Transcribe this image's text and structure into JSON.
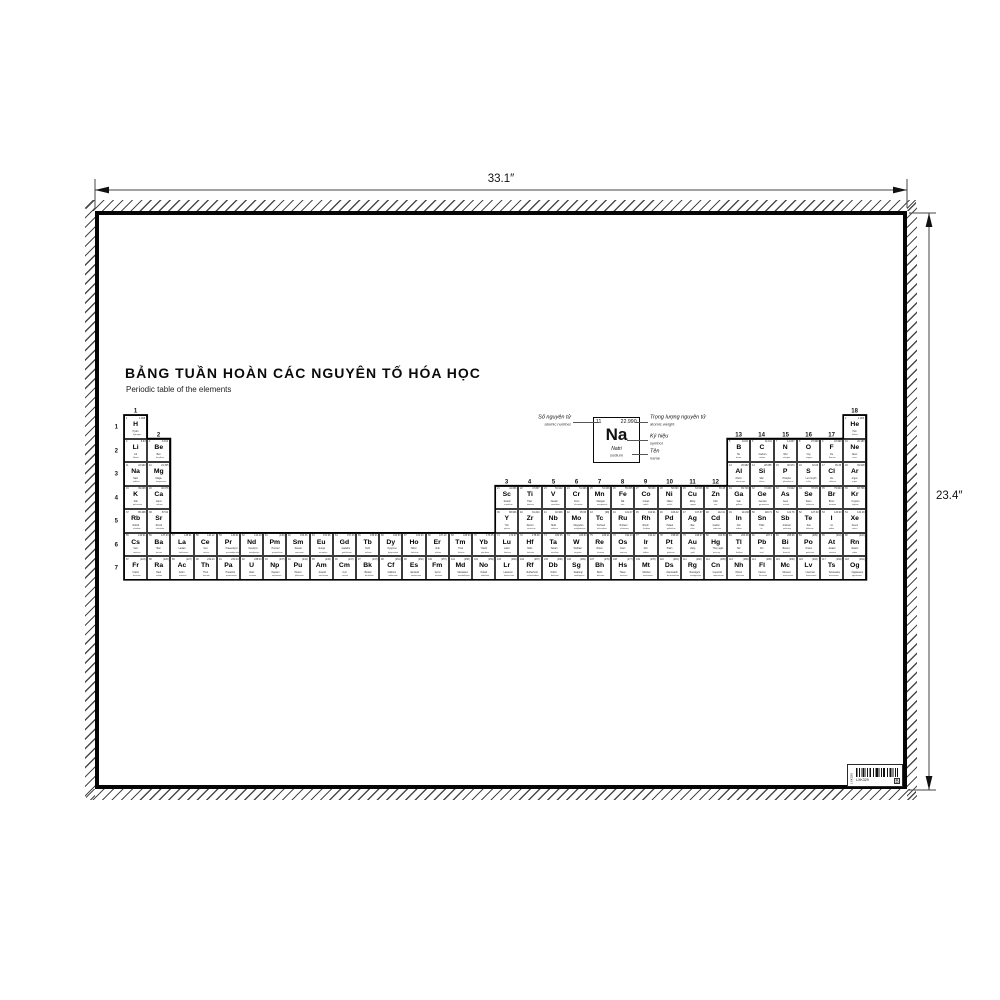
{
  "poster": {
    "title": "BẢNG TUẦN HOÀN CÁC NGUYÊN TỐ HÓA HỌC",
    "subtitle": "Periodic table of the elements"
  },
  "dimensions": {
    "width": "33.1″",
    "height": "23.4″"
  },
  "legend": {
    "atomic_number_vi": "Số nguyên tử",
    "atomic_number_en": "atomic number",
    "atomic_weight_vi": "Trọng lượng nguyên tử",
    "atomic_weight_en": "atomic weight",
    "symbol_vi": "Ký hiệu",
    "symbol_en": "symbol",
    "name_vi": "Tên",
    "name_en": "name",
    "example": {
      "number": "11",
      "weight": "22.990",
      "symbol": "Na",
      "name_vi": "Natri",
      "name_en": "sodium"
    }
  },
  "table": {
    "period_labels": [
      "1",
      "2",
      "3",
      "4",
      "5",
      "6",
      "7"
    ],
    "group_labels": [
      [
        "1",
        1,
        1
      ],
      [
        "2",
        2,
        2
      ],
      [
        "3",
        17,
        4
      ],
      [
        "4",
        18,
        4
      ],
      [
        "5",
        19,
        4
      ],
      [
        "6",
        20,
        4
      ],
      [
        "7",
        21,
        4
      ],
      [
        "8",
        22,
        4
      ],
      [
        "9",
        23,
        4
      ],
      [
        "10",
        24,
        4
      ],
      [
        "11",
        25,
        4
      ],
      [
        "12",
        26,
        4
      ],
      [
        "13",
        27,
        2
      ],
      [
        "14",
        28,
        2
      ],
      [
        "15",
        29,
        2
      ],
      [
        "16",
        30,
        2
      ],
      [
        "17",
        31,
        2
      ],
      [
        "18",
        32,
        1
      ]
    ],
    "elements": [
      [
        1,
        "H",
        "1.008",
        "Hydro",
        "hydrogen"
      ],
      [
        2,
        "He",
        "4.003",
        "Heli",
        "helium"
      ],
      [
        3,
        "Li",
        "6.94",
        "Liti",
        "lithium"
      ],
      [
        4,
        "Be",
        "9.012",
        "Beri",
        "beryllium"
      ],
      [
        5,
        "B",
        "10.81",
        "Bo",
        "boron"
      ],
      [
        6,
        "C",
        "12.011",
        "Cacbon",
        "carbon"
      ],
      [
        7,
        "N",
        "14.007",
        "Nitơ",
        "nitrogen"
      ],
      [
        8,
        "O",
        "15.999",
        "Oxy",
        "oxygen"
      ],
      [
        9,
        "F",
        "18.998",
        "Flo",
        "fluorine"
      ],
      [
        10,
        "Ne",
        "20.180",
        "Neon",
        "neon"
      ],
      [
        11,
        "Na",
        "22.990",
        "Natri",
        "sodium"
      ],
      [
        12,
        "Mg",
        "24.305",
        "Magie",
        "magnesium"
      ],
      [
        13,
        "Al",
        "26.982",
        "Nhôm",
        "aluminium"
      ],
      [
        14,
        "Si",
        "28.085",
        "Silic",
        "silicon"
      ],
      [
        15,
        "P",
        "30.974",
        "Photpho",
        "phosphorus"
      ],
      [
        16,
        "S",
        "32.06",
        "Lưu huỳnh",
        "sulfur"
      ],
      [
        17,
        "Cl",
        "35.45",
        "Clo",
        "chlorine"
      ],
      [
        18,
        "Ar",
        "39.948",
        "Argon",
        "argon"
      ],
      [
        19,
        "K",
        "39.098",
        "Kali",
        "potassium"
      ],
      [
        20,
        "Ca",
        "40.078",
        "Canxi",
        "calcium"
      ],
      [
        21,
        "Sc",
        "44.956",
        "Scandi",
        "scandium"
      ],
      [
        22,
        "Ti",
        "47.867",
        "Titan",
        "titanium"
      ],
      [
        23,
        "V",
        "50.942",
        "Vanadi",
        "vanadium"
      ],
      [
        24,
        "Cr",
        "51.996",
        "Crom",
        "chromium"
      ],
      [
        25,
        "Mn",
        "54.938",
        "Mangan",
        "manganese"
      ],
      [
        26,
        "Fe",
        "55.845",
        "Sắt",
        "iron"
      ],
      [
        27,
        "Co",
        "58.933",
        "Coban",
        "cobalt"
      ],
      [
        28,
        "Ni",
        "58.693",
        "Niken",
        "nickel"
      ],
      [
        29,
        "Cu",
        "63.546",
        "Đồng",
        "copper"
      ],
      [
        30,
        "Zn",
        "65.38",
        "Kẽm",
        "zinc"
      ],
      [
        31,
        "Ga",
        "69.723",
        "Gali",
        "gallium"
      ],
      [
        32,
        "Ge",
        "72.630",
        "Gemani",
        "germanium"
      ],
      [
        33,
        "As",
        "74.922",
        "Asen",
        "arsenic"
      ],
      [
        34,
        "Se",
        "78.971",
        "Selen",
        "selenium"
      ],
      [
        35,
        "Br",
        "79.904",
        "Brom",
        "bromine"
      ],
      [
        36,
        "Kr",
        "83.798",
        "Krypton",
        "krypton"
      ],
      [
        37,
        "Rb",
        "85.468",
        "Rubidi",
        "rubidium"
      ],
      [
        38,
        "Sr",
        "87.62",
        "Stronti",
        "strontium"
      ],
      [
        39,
        "Y",
        "88.906",
        "Yttri",
        "yttrium"
      ],
      [
        40,
        "Zr",
        "91.224",
        "Zirconi",
        "zirconium"
      ],
      [
        41,
        "Nb",
        "92.906",
        "Niobi",
        "niobium"
      ],
      [
        42,
        "Mo",
        "95.95",
        "Molypden",
        "molybdenum"
      ],
      [
        43,
        "Tc",
        "(98)",
        "Techneti",
        "technetium"
      ],
      [
        44,
        "Ru",
        "101.07",
        "Rutheni",
        "ruthenium"
      ],
      [
        45,
        "Rh",
        "102.91",
        "Rhodi",
        "rhodium"
      ],
      [
        46,
        "Pd",
        "106.42",
        "Paladi",
        "palladium"
      ],
      [
        47,
        "Ag",
        "107.87",
        "Bạc",
        "silver"
      ],
      [
        48,
        "Cd",
        "112.41",
        "Cadimi",
        "cadmium"
      ],
      [
        49,
        "In",
        "114.82",
        "Indi",
        "indium"
      ],
      [
        50,
        "Sn",
        "118.71",
        "Thiếc",
        "tin"
      ],
      [
        51,
        "Sb",
        "121.76",
        "Antimon",
        "antimony"
      ],
      [
        52,
        "Te",
        "127.60",
        "Telu",
        "tellurium"
      ],
      [
        53,
        "I",
        "126.90",
        "Iot",
        "iodine"
      ],
      [
        54,
        "Xe",
        "131.29",
        "Xenon",
        "xenon"
      ],
      [
        55,
        "Cs",
        "132.91",
        "Xesi",
        "caesium"
      ],
      [
        56,
        "Ba",
        "137.33",
        "Bari",
        "barium"
      ],
      [
        57,
        "La",
        "138.91",
        "Lantan",
        "lanthanum"
      ],
      [
        58,
        "Ce",
        "140.12",
        "Ceri",
        "cerium"
      ],
      [
        59,
        "Pr",
        "140.91",
        "Praseodymi",
        "praseodymium"
      ],
      [
        60,
        "Nd",
        "144.24",
        "Neodymi",
        "neodymium"
      ],
      [
        61,
        "Pm",
        "(145)",
        "Prometi",
        "promethium"
      ],
      [
        62,
        "Sm",
        "150.36",
        "Samari",
        "samarium"
      ],
      [
        63,
        "Eu",
        "151.96",
        "Europi",
        "europium"
      ],
      [
        64,
        "Gd",
        "157.25",
        "Gadolini",
        "gadolinium"
      ],
      [
        65,
        "Tb",
        "158.93",
        "Terbi",
        "terbium"
      ],
      [
        66,
        "Dy",
        "162.50",
        "Dysprosi",
        "dysprosium"
      ],
      [
        67,
        "Ho",
        "164.93",
        "Holmi",
        "holmium"
      ],
      [
        68,
        "Er",
        "167.26",
        "Erbi",
        "erbium"
      ],
      [
        69,
        "Tm",
        "168.93",
        "Thuli",
        "thulium"
      ],
      [
        70,
        "Yb",
        "173.05",
        "Ytterbi",
        "ytterbium"
      ],
      [
        71,
        "Lu",
        "174.97",
        "Luteti",
        "lutetium"
      ],
      [
        72,
        "Hf",
        "178.49",
        "Hafni",
        "hafnium"
      ],
      [
        73,
        "Ta",
        "180.95",
        "Tantan",
        "tantalum"
      ],
      [
        74,
        "W",
        "183.84",
        "Wolfram",
        "tungsten"
      ],
      [
        75,
        "Re",
        "186.21",
        "Rheni",
        "rhenium"
      ],
      [
        76,
        "Os",
        "190.23",
        "Osmi",
        "osmium"
      ],
      [
        77,
        "Ir",
        "192.22",
        "Iridi",
        "iridium"
      ],
      [
        78,
        "Pt",
        "195.08",
        "Platin",
        "platinum"
      ],
      [
        79,
        "Au",
        "196.97",
        "Vàng",
        "gold"
      ],
      [
        80,
        "Hg",
        "200.59",
        "Thủy ngân",
        "mercury"
      ],
      [
        81,
        "Tl",
        "204.38",
        "Tali",
        "thallium"
      ],
      [
        82,
        "Pb",
        "207.2",
        "Chì",
        "lead"
      ],
      [
        83,
        "Bi",
        "208.98",
        "Bismut",
        "bismuth"
      ],
      [
        84,
        "Po",
        "(209)",
        "Poloni",
        "polonium"
      ],
      [
        85,
        "At",
        "(210)",
        "Astatin",
        "astatine"
      ],
      [
        86,
        "Rn",
        "(222)",
        "Radon",
        "radon"
      ],
      [
        87,
        "Fr",
        "(223)",
        "Franci",
        "francium"
      ],
      [
        88,
        "Ra",
        "(226)",
        "Radi",
        "radium"
      ],
      [
        89,
        "Ac",
        "(227)",
        "Actini",
        "actinium"
      ],
      [
        90,
        "Th",
        "232.04",
        "Thori",
        "thorium"
      ],
      [
        91,
        "Pa",
        "231.04",
        "Protactini",
        "protactinium"
      ],
      [
        92,
        "U",
        "238.03",
        "Urani",
        "uranium"
      ],
      [
        93,
        "Np",
        "(237)",
        "Neptuni",
        "neptunium"
      ],
      [
        94,
        "Pu",
        "(244)",
        "Plutoni",
        "plutonium"
      ],
      [
        95,
        "Am",
        "(243)",
        "Americi",
        "americium"
      ],
      [
        96,
        "Cm",
        "(247)",
        "Curi",
        "curium"
      ],
      [
        97,
        "Bk",
        "(247)",
        "Berkeli",
        "berkelium"
      ],
      [
        98,
        "Cf",
        "(251)",
        "Californi",
        "californium"
      ],
      [
        99,
        "Es",
        "(252)",
        "Einsteini",
        "einsteinium"
      ],
      [
        100,
        "Fm",
        "(257)",
        "Fermi",
        "fermium"
      ],
      [
        101,
        "Md",
        "(258)",
        "Mendelevi",
        "mendelevium"
      ],
      [
        102,
        "No",
        "(259)",
        "Nobeli",
        "nobelium"
      ],
      [
        103,
        "Lr",
        "(266)",
        "Lawrenci",
        "lawrencium"
      ],
      [
        104,
        "Rf",
        "(267)",
        "Rutherfordi",
        "rutherfordium"
      ],
      [
        105,
        "Db",
        "(268)",
        "Dubni",
        "dubnium"
      ],
      [
        106,
        "Sg",
        "(269)",
        "Seaborgi",
        "seaborgium"
      ],
      [
        107,
        "Bh",
        "(270)",
        "Bohri",
        "bohrium"
      ],
      [
        108,
        "Hs",
        "(277)",
        "Hassi",
        "hassium"
      ],
      [
        109,
        "Mt",
        "(278)",
        "Meitneri",
        "meitnerium"
      ],
      [
        110,
        "Ds",
        "(281)",
        "Darmstadti",
        "darmstadtium"
      ],
      [
        111,
        "Rg",
        "(282)",
        "Roentgeni",
        "roentgenium"
      ],
      [
        112,
        "Cn",
        "(285)",
        "Copernici",
        "copernicium"
      ],
      [
        113,
        "Nh",
        "(286)",
        "Nihoni",
        "nihonium"
      ],
      [
        114,
        "Fl",
        "(289)",
        "Flerovi",
        "flerovium"
      ],
      [
        115,
        "Mc",
        "(290)",
        "Moscovi",
        "moscovium"
      ],
      [
        116,
        "Lv",
        "(293)",
        "Livermori",
        "livermorium"
      ],
      [
        117,
        "Ts",
        "(294)",
        "Tennessine",
        "tennessine"
      ],
      [
        118,
        "Og",
        "(294)",
        "Oganesson",
        "oganesson"
      ]
    ]
  },
  "barcode": {
    "code": "LXK329",
    "side_text": "LXK329",
    "box_mark": "B"
  }
}
